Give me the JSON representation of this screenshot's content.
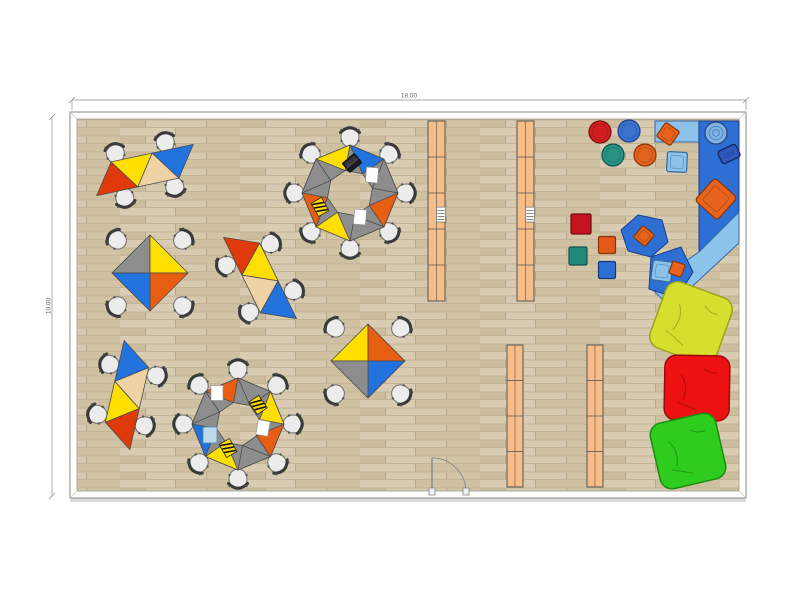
{
  "dimensions": {
    "top_label": "18.00",
    "left_label": "10.00"
  },
  "palette": {
    "floor_base": "#d2c3a5",
    "floor_planks": [
      "#daccb2",
      "#cfc0a2",
      "#ccbd9e",
      "#d8cab0",
      "#d3c4a6"
    ],
    "floor_seam": "#b6a78a",
    "floor_rowline": "#c3b496",
    "wall_fill": "#fdfdfc",
    "wall_stroke": "#8a8a8a",
    "wall_shadow": "#dcdcd8",
    "dim_line": "#8a8a8a",
    "dim_text": "#666666",
    "table_red": "#e03a0c",
    "table_orange": "#e75d12",
    "table_yellow": "#ffdf00",
    "table_tan": "#f0d3a4",
    "table_blue": "#2273dd",
    "table_gray": "#8d8d8d",
    "table_stroke": "#4a4a4a",
    "chair_seat": "#ececec",
    "chair_stroke": "#6b6b6b",
    "chair_back": "#3a3a3a",
    "shelf": "#f6bd88",
    "shelf_stroke": "#555555",
    "mat_dark_blue": "#2e6fd4",
    "mat_dark_stroke": "#1a3e8c",
    "mat_light_blue": "#8cc3ea",
    "mat_light_stroke": "#39679f",
    "cushion_orange": "#e8641c",
    "cushion_orange_stroke": "#8a3408",
    "basket_blue": "#7fb4e0",
    "basket_blue_stroke": "#27427e",
    "basket_dark": "#2a52b4",
    "basket_dark_stroke": "#16265e",
    "item_paper": "#ffffff",
    "item_paper_blue": "#bcd9ee",
    "item_notebook": "#ffd900",
    "item_laptop": "#1c1c1c"
  },
  "room": {
    "x": 70,
    "y": 112,
    "w": 676,
    "h": 386,
    "wall": 7
  },
  "door": {
    "hinge_x": 432,
    "hinge_y": 492,
    "leaf": 34
  },
  "shelves": [
    {
      "x": 428,
      "y": 121,
      "w": 17,
      "h": 180,
      "dividers": [
        0.2,
        0.4,
        0.6,
        0.8
      ],
      "item": true
    },
    {
      "x": 517,
      "y": 121,
      "w": 17,
      "h": 180,
      "dividers": [
        0.2,
        0.4,
        0.6,
        0.8
      ],
      "item": true
    },
    {
      "x": 507,
      "y": 345,
      "w": 16,
      "h": 142,
      "dividers": [
        0.25,
        0.5,
        0.75
      ],
      "item": false
    },
    {
      "x": 587,
      "y": 345,
      "w": 16,
      "h": 142,
      "dividers": [
        0.25,
        0.5,
        0.75
      ],
      "item": false
    }
  ],
  "table_strips": [
    {
      "cx": 145,
      "cy": 170,
      "rot": -12,
      "base": 42,
      "h": 30,
      "colors": [
        "red",
        "yellow",
        "tan",
        "blue"
      ]
    },
    {
      "cx": 260,
      "cy": 278,
      "rot": 64,
      "base": 42,
      "h": 30,
      "colors": [
        "red",
        "yellow",
        "tan",
        "blue"
      ]
    },
    {
      "cx": 127,
      "cy": 395,
      "rot": 103,
      "base": 42,
      "h": 30,
      "colors": [
        "blue",
        "tan",
        "yellow",
        "red"
      ]
    }
  ],
  "octagon_clusters": [
    {
      "cx": 350,
      "cy": 193,
      "R": 48,
      "apex": 23,
      "colors": [
        "yellow",
        "blue",
        "gray",
        "orange",
        "gray",
        "yellow",
        "orange",
        "gray"
      ]
    },
    {
      "cx": 238,
      "cy": 424,
      "R": 46,
      "apex": 22,
      "colors": [
        "orange",
        "gray",
        "yellow",
        "orange",
        "gray",
        "yellow",
        "blue",
        "gray"
      ]
    }
  ],
  "diamond_tables": [
    {
      "cx": 150,
      "cy": 273,
      "d": 38,
      "colors": [
        "gray",
        "yellow",
        "orange",
        "blue"
      ]
    },
    {
      "cx": 368,
      "cy": 361,
      "d": 37,
      "colors": [
        "yellow",
        "orange",
        "blue",
        "gray"
      ]
    }
  ],
  "chairs": [
    {
      "x": 115,
      "y": 152,
      "rot": 168
    },
    {
      "x": 165,
      "y": 141,
      "rot": 168
    },
    {
      "x": 125,
      "y": 199,
      "rot": -12
    },
    {
      "x": 175,
      "y": 188,
      "rot": -12
    },
    {
      "x": 272,
      "y": 243,
      "rot": 244
    },
    {
      "x": 295,
      "y": 290,
      "rot": 244
    },
    {
      "x": 225,
      "y": 266,
      "rot": 64
    },
    {
      "x": 248,
      "y": 313,
      "rot": 64
    },
    {
      "x": 158,
      "y": 376,
      "rot": 283
    },
    {
      "x": 146,
      "y": 426,
      "rot": 283
    },
    {
      "x": 108,
      "y": 364,
      "rot": 103
    },
    {
      "x": 96,
      "y": 414,
      "rot": 103
    },
    {
      "x": 350,
      "y": 136,
      "rot": 180
    },
    {
      "x": 390,
      "y": 153,
      "rot": 225
    },
    {
      "x": 407,
      "y": 193,
      "rot": 270
    },
    {
      "x": 390,
      "y": 233,
      "rot": 315
    },
    {
      "x": 350,
      "y": 250,
      "rot": 0
    },
    {
      "x": 310,
      "y": 233,
      "rot": 45
    },
    {
      "x": 293,
      "y": 193,
      "rot": 90
    },
    {
      "x": 310,
      "y": 153,
      "rot": 135
    },
    {
      "x": 238,
      "y": 368,
      "rot": 180
    },
    {
      "x": 278,
      "y": 384,
      "rot": 225
    },
    {
      "x": 294,
      "y": 424,
      "rot": 270
    },
    {
      "x": 278,
      "y": 464,
      "rot": 315
    },
    {
      "x": 238,
      "y": 480,
      "rot": 0
    },
    {
      "x": 198,
      "y": 464,
      "rot": 45
    },
    {
      "x": 182,
      "y": 424,
      "rot": 90
    },
    {
      "x": 198,
      "y": 384,
      "rot": 135
    },
    {
      "x": 116,
      "y": 239,
      "rot": 130
    },
    {
      "x": 184,
      "y": 239,
      "rot": 230
    },
    {
      "x": 184,
      "y": 307,
      "rot": 310
    },
    {
      "x": 116,
      "y": 307,
      "rot": 50
    },
    {
      "x": 334,
      "y": 327,
      "rot": 130
    },
    {
      "x": 402,
      "y": 327,
      "rot": 230
    },
    {
      "x": 402,
      "y": 395,
      "rot": 310
    },
    {
      "x": 334,
      "y": 395,
      "rot": 50
    }
  ],
  "table_items": [
    {
      "type": "laptop",
      "x": 352,
      "y": 163,
      "rot": -40
    },
    {
      "type": "paper",
      "x": 372,
      "y": 175,
      "rot": 5
    },
    {
      "type": "paper",
      "x": 360,
      "y": 217,
      "rot": 5
    },
    {
      "type": "notebook",
      "x": 320,
      "y": 207,
      "rot": -30
    },
    {
      "type": "paper",
      "x": 217,
      "y": 393,
      "rot": 0
    },
    {
      "type": "notebook",
      "x": 258,
      "y": 405,
      "rot": -35
    },
    {
      "type": "paper",
      "x": 263,
      "y": 428,
      "rot": 10
    },
    {
      "type": "notebook",
      "x": 228,
      "y": 448,
      "rot": -30
    },
    {
      "type": "paper_blue",
      "x": 210,
      "y": 435,
      "rot": 0
    }
  ],
  "play_area": {
    "mats": [
      {
        "name": "mat-top",
        "tone": "light",
        "points": [
          [
            655,
            121
          ],
          [
            700,
            121
          ],
          [
            700,
            142
          ],
          [
            655,
            142
          ]
        ]
      },
      {
        "name": "mat-right",
        "tone": "dark",
        "points": [
          [
            699,
            121
          ],
          [
            739,
            121
          ],
          [
            739,
            212
          ],
          [
            699,
            252
          ]
        ]
      },
      {
        "name": "mat-diagonal",
        "tone": "light",
        "points": [
          [
            699,
            252
          ],
          [
            739,
            212
          ],
          [
            739,
            243
          ],
          [
            670,
            307
          ],
          [
            649,
            286
          ]
        ]
      },
      {
        "name": "mat-hex",
        "tone": "dark",
        "points": [
          [
            638,
            215
          ],
          [
            662,
            220
          ],
          [
            668,
            242
          ],
          [
            651,
            257
          ],
          [
            628,
            251
          ],
          [
            621,
            230
          ]
        ]
      },
      {
        "name": "mat-pent",
        "tone": "dark",
        "points": [
          [
            651,
            257
          ],
          [
            681,
            247
          ],
          [
            693,
            272
          ],
          [
            677,
            298
          ],
          [
            649,
            289
          ]
        ]
      }
    ],
    "baskets": [
      {
        "type": "round",
        "x": 716,
        "y": 133,
        "r": 11
      },
      {
        "type": "box",
        "x": 729,
        "y": 154,
        "rot": -25
      }
    ],
    "mat_cushions": [
      {
        "x": 668,
        "y": 134,
        "s": 17,
        "rot": 35,
        "fill": "cushion_orange",
        "stroke": "cushion_orange_stroke"
      },
      {
        "x": 716,
        "y": 199,
        "s": 30,
        "rot": 42,
        "fill": "cushion_orange",
        "stroke": "cushion_orange_stroke"
      },
      {
        "x": 644,
        "y": 236,
        "s": 15,
        "rot": 40,
        "fill": "cushion_orange",
        "stroke": "cushion_orange_stroke"
      },
      {
        "x": 662,
        "y": 271,
        "s": 20,
        "rot": 8,
        "fill": "mat_light_blue",
        "stroke": "mat_light_stroke"
      },
      {
        "x": 677,
        "y": 269,
        "s": 13,
        "rot": 20,
        "fill": "cushion_orange",
        "stroke": "cushion_orange_stroke"
      },
      {
        "x": 677,
        "y": 162,
        "s": 20,
        "rot": 3,
        "fill": "mat_light_blue",
        "stroke": "mat_light_stroke"
      }
    ],
    "poufs": [
      {
        "x": 600,
        "y": 132,
        "r": 11,
        "fill": "#cf1f1f",
        "stroke": "#7a0d0d"
      },
      {
        "x": 629,
        "y": 131,
        "r": 11,
        "fill": "#3a72cc",
        "stroke": "#1c3f8c"
      },
      {
        "x": 613,
        "y": 155,
        "r": 11,
        "fill": "#2a9186",
        "stroke": "#0f5249"
      },
      {
        "x": 645,
        "y": 155,
        "r": 11,
        "fill": "#e2621f",
        "stroke": "#8a3408"
      }
    ],
    "floor_cushions": [
      {
        "x": 581,
        "y": 224,
        "s": 20,
        "fill": "#c41420",
        "stroke": "#6f0a10"
      },
      {
        "x": 607,
        "y": 245,
        "s": 17,
        "fill": "#e2591a",
        "stroke": "#8a3408"
      },
      {
        "x": 578,
        "y": 256,
        "s": 18,
        "fill": "#20897c",
        "stroke": "#0f544c"
      },
      {
        "x": 607,
        "y": 270,
        "s": 17,
        "fill": "#2e6fd4",
        "stroke": "#16387a"
      }
    ],
    "beanbags": [
      {
        "x": 691,
        "y": 323,
        "s": 70,
        "rot": 20,
        "fill": "#d6de2e",
        "stroke": "#9aa318"
      },
      {
        "x": 697,
        "y": 388,
        "s": 65,
        "rot": 1,
        "fill": "#ee1111",
        "stroke": "#990c0c"
      },
      {
        "x": 688,
        "y": 451,
        "s": 67,
        "rot": -13,
        "fill": "#2ecc1e",
        "stroke": "#1d8b10"
      }
    ]
  }
}
